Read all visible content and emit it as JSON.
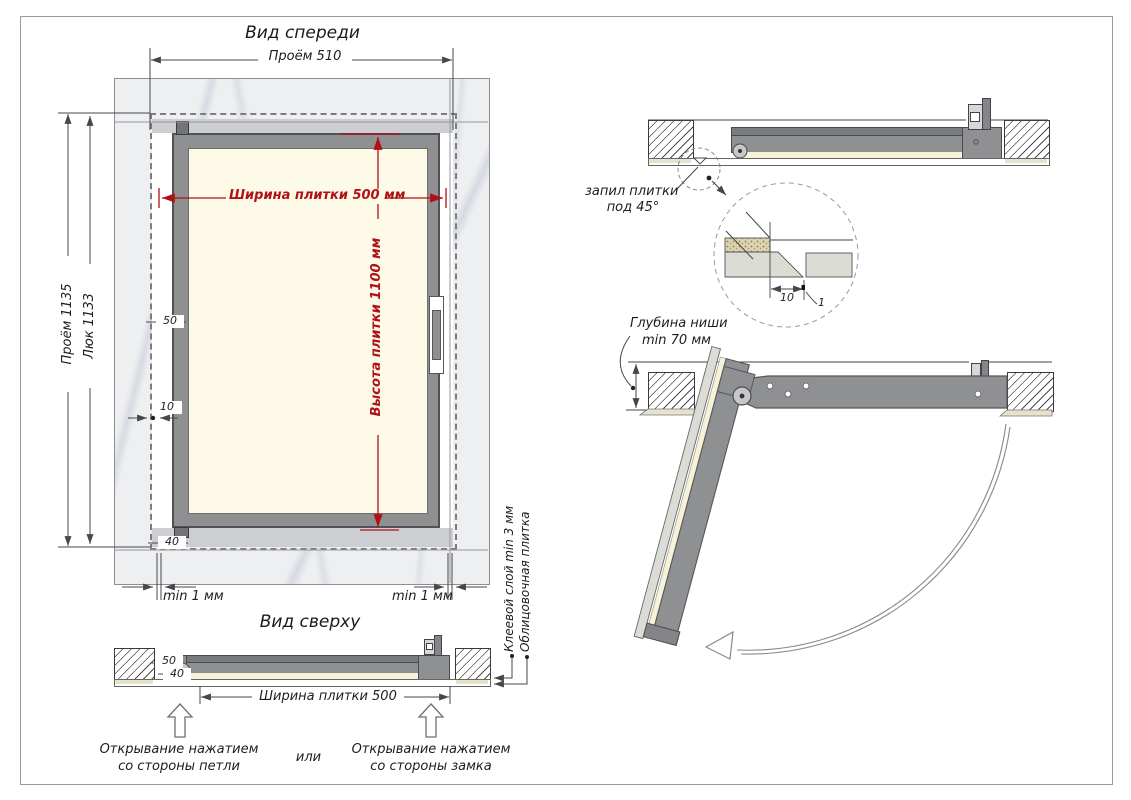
{
  "front_view": {
    "title": "Вид спереди",
    "dim_opening_w": "Проём 510",
    "dim_tile_w": "Ширина плитки 500 мм",
    "dim_tile_h": "Высота плитки 1100 мм",
    "dim_opening_h": "Проём 1135",
    "dim_hatch_h": "Люк 1133",
    "d50": "50",
    "d10": "10",
    "d40": "40",
    "gap_left": "min 1 мм",
    "gap_right": "min 1 мм"
  },
  "top_view": {
    "title": "Вид сверху",
    "d50": "50",
    "d40": "40",
    "dim_tile_w": "Ширина плитки 500",
    "open_hinge_1": "Открывание нажатием",
    "open_hinge_2": "со стороны петли",
    "or_word": "или",
    "open_lock_1": "Открывание нажатием",
    "open_lock_2": "со стороны замка",
    "label_glue": "Клеевой слой min 3 мм",
    "label_tile": "Облицовочная плитка"
  },
  "section_closed": {
    "cut_label_1": "запил плитки",
    "cut_label_2": "под 45°",
    "detail_d10": "10",
    "detail_d1": "1"
  },
  "section_open": {
    "depth_label_1": "Глубина ниши",
    "depth_label_2": "min 70 мм"
  },
  "colors": {
    "dim_red": "#b01117",
    "line_gray": "#46474a",
    "frame_gray": "#8f9092",
    "panel_cream": "#fdfbe8",
    "wall_light": "#edeff1"
  }
}
